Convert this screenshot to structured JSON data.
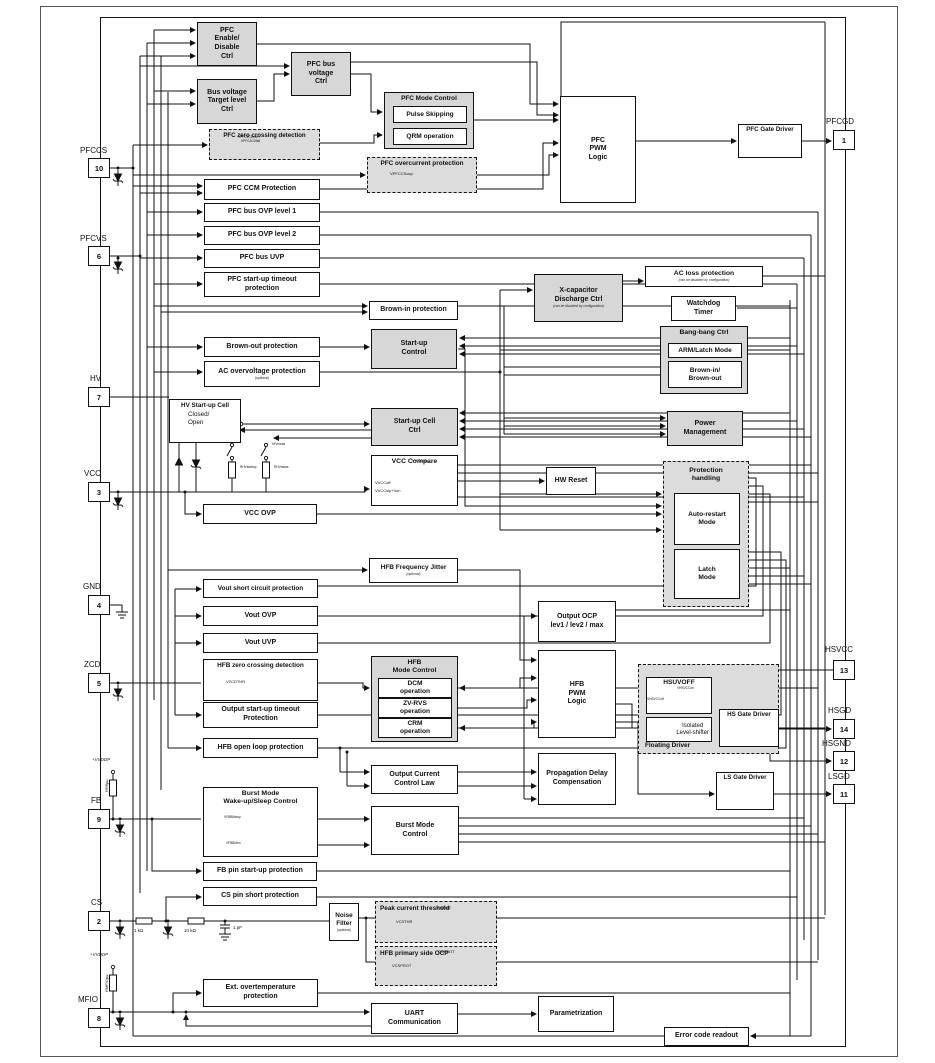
{
  "pins": {
    "pfccs": {
      "name": "PFCCS",
      "num": "10"
    },
    "pfcvs": {
      "name": "PFCVS",
      "num": "6"
    },
    "hv": {
      "name": "HV",
      "num": "7"
    },
    "vcc": {
      "name": "VCC",
      "num": "3"
    },
    "gnd": {
      "name": "GND",
      "num": "4"
    },
    "zcd": {
      "name": "ZCD",
      "num": "5"
    },
    "fb": {
      "name": "FB",
      "num": "9"
    },
    "cs": {
      "name": "CS",
      "num": "2"
    },
    "mfio": {
      "name": "MFIO",
      "num": "8"
    },
    "pfcgd": {
      "name": "PFCGD",
      "num": "1"
    },
    "hsvcc": {
      "name": "HSVCC",
      "num": "13"
    },
    "hsgd": {
      "name": "HSGD",
      "num": "14"
    },
    "hsgnd": {
      "name": "HSGND",
      "num": "12"
    },
    "lsgd": {
      "name": "LSGD",
      "num": "11"
    }
  },
  "blocks": {
    "pfc_enable": "PFC\nEnable/\nDisable\nCtrl",
    "pfc_bus_voltage": "PFC bus\nvoltage\nCtrl",
    "bus_voltage_target": "Bus voltage\nTarget level\nCtrl",
    "pfc_mode_hdr": "PFC Mode Control",
    "pulse_skipping": "Pulse Skipping",
    "qrm": "QRM operation",
    "pfc_zcd_hdr": "PFC zero crossing detection",
    "pfc_ocp_hdr": "PFC overcurrent protection",
    "pfc_pwm": "PFC\nPWM\nLogic",
    "pfc_gate_driver": "PFC Gate Driver",
    "pfc_ccm": "PFC CCM Protection",
    "pfc_ovp1": "PFC bus OVP level 1",
    "pfc_ovp2": "PFC bus OVP level 2",
    "pfc_uvp": "PFC bus UVP",
    "pfc_sut": "PFC start-up timeout\nprotection",
    "brown_in": "Brown-in protection",
    "startup_control": "Start-up\nControl",
    "brown_out": "Brown-out protection",
    "ac_ovp": "AC overvoltage protection",
    "xcap": "X-capacitor\nDischarge Ctrl",
    "ac_loss": "AC loss protection",
    "watchdog": "Watchdog\nTimer",
    "bangbang_hdr": "Bang-bang Ctrl",
    "arm_latch": "ARM/Latch Mode",
    "brown_in_out": "Brown-in/\nBrown-out",
    "power_mgmt": "Power\nManagement",
    "hv_cell_hdr": "HV Start-up Cell",
    "hv_closed": "Closed/",
    "hv_open": "Open",
    "startup_cell_ctrl": "Start-up Cell\nCtrl",
    "vcc_compare_hdr": "VCC Compare",
    "hw_reset": "HW Reset",
    "prot_hdr": "Protection\nhandling",
    "auto_restart": "Auto-restart\nMode",
    "latch": "Latch\nMode",
    "vcc_ovp": "VCC OVP",
    "hfb_jitter": "HFB Frequency Jitter",
    "vout_scp": "Vout short circuit protection",
    "vout_ovp": "Vout OVP",
    "vout_uvp": "Vout UVP",
    "hfb_zcd_hdr": "HFB zero crossing detection",
    "out_sut": "Output start-up timeout\nProtection",
    "hfb_olp": "HFB open loop protection",
    "hfb_mode_hdr": "HFB\nMode Control",
    "dcm": "DCM\noperation",
    "zvrvs": "ZV-RVS\noperation",
    "crm": "CRM\noperation",
    "output_ocp": "Output OCP\nlev1 / lev2 / max",
    "hfb_pwm": "HFB\nPWM\nLogic",
    "occl": "Output Current\nControl Law",
    "burst_wake_hdr": "Burst Mode\nWake-up/Sleep Control",
    "burst_ctrl": "Burst Mode\nControl",
    "fb_sut": "FB pin start-up protection",
    "cs_short": "CS pin short protection",
    "floating_hdr": "Floating Driver",
    "hsuvoff": "HSUVOFF",
    "level_shifter": "Isolated\nLevel-shifter",
    "hs_gate": "HS Gate Driver",
    "prop_delay": "Propagation Delay\nCompensation",
    "ls_gate": "LS Gate Driver",
    "noise_filter": "Noise\nFilter",
    "peak_hdr": "Peak current threshold",
    "hfb_ocp_hdr": "HFB primary side OCP",
    "ext_otp": "Ext. overtemperature\nprotection",
    "uart": "UART\nCommunication",
    "param": "Parametrization",
    "error_code": "Error code readout"
  },
  "subs": {
    "optional": "(optional)",
    "disabled": "(can be disabled by configuration)"
  },
  "signals": {
    "vpfczcd": "VPFCZCDrise /\nVPFCZCDfall",
    "vpfccsocp": "VPFCCSocp",
    "vzcdthr": "VZCDTHR",
    "vvccon": "VVCCon",
    "vvccoff": "VVCCoff",
    "vvccslp": "VVCCslp+Von",
    "vhsvccon": "VHSVCCon",
    "vhsvccoff": "VHSVCCoff",
    "vfbbmwup": "VFBBMwup",
    "vfbbmen": "VFBBMen",
    "csthr": "CSTHR",
    "vcsthr": "VCSTHR",
    "csprot": "CSPROT",
    "vcsprot": "VCSPROT"
  },
  "parts": {
    "vddp": "+VVDDP",
    "rfbpu": "RFBpu",
    "rmfiopu": "RMFIOpu",
    "r1k": "1 kΩ",
    "r10k": "10 kΩ",
    "c1pf": "1 pF",
    "rhvstartup": "RHVstartup",
    "rhvmeas": "RHVmeas",
    "ihvmeas": "IHVmeas"
  }
}
